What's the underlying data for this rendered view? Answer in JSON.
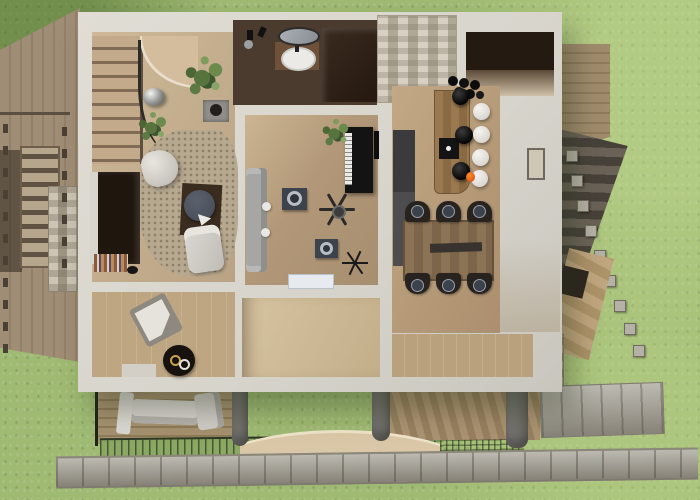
{
  "scene": {
    "title": "3D rendered top-down floor plan of a house on a lawn",
    "view": "top-down isometric render",
    "visible_text": "none"
  },
  "colors": {
    "grass": "#9fba73",
    "deckWood": "#a08d75",
    "wall": "#d7d4cc",
    "floorTan": "#b9a384",
    "floorMid": "#b29878",
    "floorLight": "#c3ae8a",
    "rug": "#b7a890",
    "bathFloor": "#4a3b2e",
    "stone": "#b7ab97",
    "stone2": "#c6bca9",
    "piano": "#131313",
    "sofaGray": "#a6a6a4",
    "island": "#9a7950",
    "counterGray": "#4d4d4f",
    "stool": "#cfccc6",
    "chair": "#28231f",
    "diningTable": "#8b7356",
    "tableNavy": "#434a55",
    "path": "#a39f94",
    "stairDark": "#47413a",
    "porchWood": "#a5916f",
    "curveDeck": "#d9c7a7",
    "plantGreen": "#57743f"
  },
  "house": {
    "rooms": [
      {
        "name": "stair-hall",
        "features": [
          "l-shaped staircase",
          "curved landing",
          "two potted plants",
          "planter box",
          "mirror ball",
          "area rug",
          "bean bag",
          "media console",
          "bookshelf",
          "round navy table",
          "white chaise"
        ]
      },
      {
        "name": "bathroom",
        "features": [
          "vanity counter",
          "oval sink",
          "mirror",
          "wall taps",
          "dark shower cabinet"
        ]
      },
      {
        "name": "living-music-room",
        "features": [
          "upright piano",
          "gray sofa",
          "ceiling fan",
          "two dark side tables",
          "starburst decor",
          "door mat",
          "plant",
          "wall art"
        ]
      },
      {
        "name": "kitchen",
        "features": [
          "wood island",
          "cooktop",
          "bottle cluster",
          "orange pepper",
          "gray counter"
        ]
      },
      {
        "name": "dining-area",
        "features": [
          "wood table",
          "dark runner"
        ]
      },
      {
        "name": "lounge-room",
        "features": [
          "lounge chair",
          "round black coffee table",
          "low bench"
        ]
      },
      {
        "name": "spare-room",
        "features": []
      },
      {
        "name": "right-hallway",
        "features": [
          "window"
        ]
      }
    ],
    "counts": {
      "bar_stools": 4,
      "pendant_lights": 3,
      "dining_chairs": 6,
      "indoor_plants": 3,
      "porch_pillars": 3,
      "stone_posts": 9
    }
  },
  "exterior": {
    "elements": [
      "left wood deck",
      "left exterior stair",
      "deck railing",
      "stone pillar",
      "stone chimney",
      "dark stair opening",
      "right wood deck",
      "right exterior stone stair",
      "stone posts",
      "front porch with outdoor sofa",
      "garden strip with fence",
      "slatted deck",
      "mesh fence",
      "curved wood deck",
      "stone path",
      "stone corner wall",
      "wood ramp",
      "lawn"
    ]
  }
}
